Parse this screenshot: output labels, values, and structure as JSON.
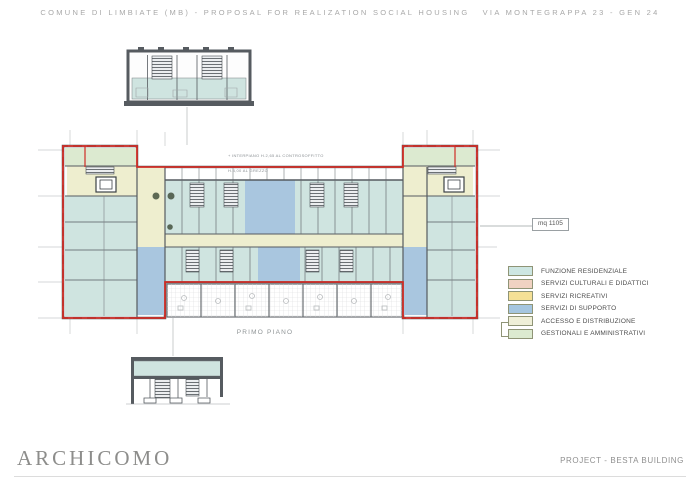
{
  "header": {
    "title": "COMUNE DI LIMBIATE (MB) - PROPOSAL FOR REALIZATION SOCIAL HOUSING   VIA MONTEGRAPPA 23 - GEN 24"
  },
  "drawing": {
    "floor_label": "PRIMO PIANO",
    "area_label": "mq 1105",
    "note_line1": "+ INTERPIANO H.2,65 AL CONTROSOFFITTO",
    "note_line2": "H.4,00 AL GREZZO"
  },
  "legend": {
    "items": [
      {
        "label": "FUNZIONE RESIDENZIALE",
        "color": "#cde6e2"
      },
      {
        "label": "SERVIZI CULTURALI E DIDATTICI",
        "color": "#f0d2c2"
      },
      {
        "label": "SERVIZI RICREATIVI",
        "color": "#f5e096"
      },
      {
        "label": "SERVIZI DI SUPPORTO",
        "color": "#a5c6e0"
      },
      {
        "label": "ACCESSO E DISTRIBUZIONE",
        "color": "#efefd8"
      },
      {
        "label": "GESTIONALI E AMMINISTRATIVI",
        "color": "#dcead0"
      }
    ]
  },
  "footer": {
    "logo": "ARCHICOMO",
    "project": "PROJECT - BESTA BUILDING"
  },
  "colors": {
    "residential": "#cfe4e0",
    "access": "#eeeecf",
    "support": "#a9c6df",
    "admin": "#dcead0",
    "perimeter_red": "#cf2d26",
    "wall_gray": "#565b60",
    "dimension_gray": "#c7cacb"
  }
}
